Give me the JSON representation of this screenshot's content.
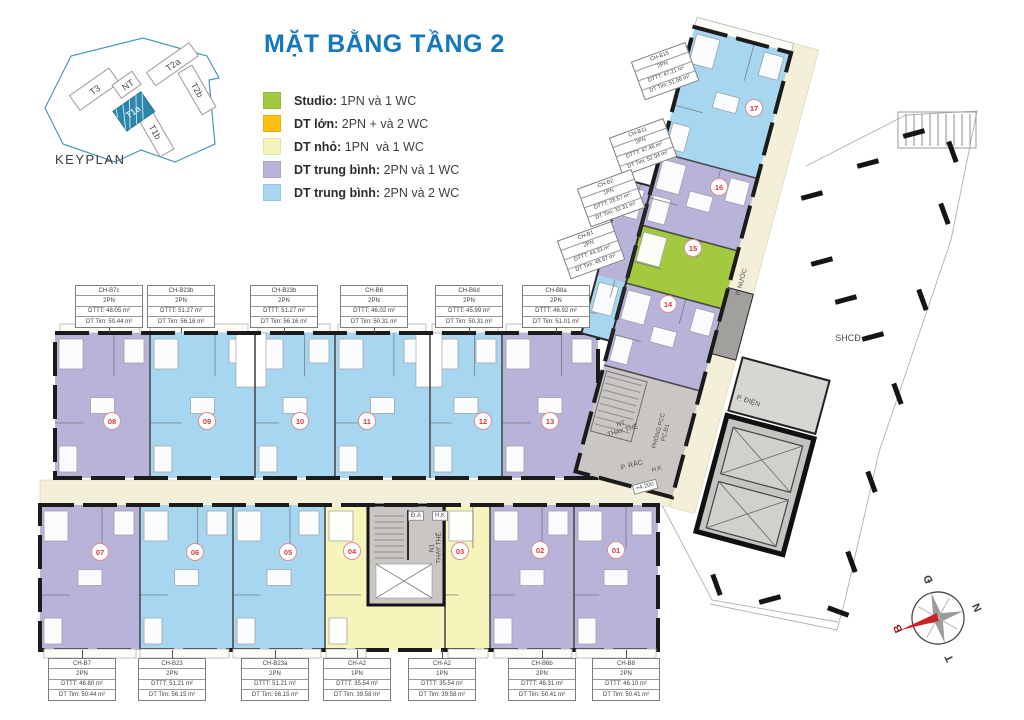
{
  "title": "MẶT BẰNG TẦNG 2",
  "title_color": "#1378be",
  "keyplan": {
    "caption": "KEYPLAN",
    "highlight": "T1a",
    "buildings": [
      {
        "label": "T3"
      },
      {
        "label": "NT"
      },
      {
        "label": "T2a"
      },
      {
        "label": "T2b"
      },
      {
        "label": "T1a"
      },
      {
        "label": "T1b"
      }
    ]
  },
  "legend": {
    "items": [
      {
        "color": "#a3c93f",
        "name": "Studio:",
        "desc": " 1PN và 1 WC"
      },
      {
        "color": "#fdc010",
        "name": "DT lớn:",
        "desc": " 2PN + và 2 WC"
      },
      {
        "color": "#f6f3bb",
        "name": "DT nhỏ:",
        "desc": " 1PN  và 1 WC"
      },
      {
        "color": "#b7b3d9",
        "name": "DT trung bình:",
        "desc": " 2PN và 1 WC"
      },
      {
        "color": "#a7d7f0",
        "name": "DT trung bình:",
        "desc": " 2PN và 2 WC"
      }
    ]
  },
  "plan": {
    "unit_labels": [
      {
        "name": "CH-B7c",
        "type": "2PN",
        "dttt": "DTTT:  48.05 m²",
        "dttim": "DT Tim: 50.44 m²",
        "x": 109,
        "y": 285,
        "rot": 0,
        "leader": "down"
      },
      {
        "name": "CH-B23b",
        "type": "2PN",
        "dttt": "DTTT:  51.27 m²",
        "dttim": "DT Tim: 56.16 m²",
        "x": 181,
        "y": 285,
        "rot": 0,
        "leader": "down"
      },
      {
        "name": "CH-B23b",
        "type": "2PN",
        "dttt": "DTTT:  51.27 m²",
        "dttim": "DT Tim: 56.16 m²",
        "x": 284,
        "y": 285,
        "rot": 0,
        "leader": "down"
      },
      {
        "name": "CH-B6",
        "type": "2PN",
        "dttt": "DTTT:  46.02 m²",
        "dttim": "DT Tim: 50.31 m²",
        "x": 374,
        "y": 285,
        "rot": 0,
        "leader": "down"
      },
      {
        "name": "CH-B6d",
        "type": "2PN",
        "dttt": "DTTT:  45.99 m²",
        "dttim": "DT Tim: 50.31 m²",
        "x": 469,
        "y": 285,
        "rot": 0,
        "leader": "down"
      },
      {
        "name": "CH-B8a",
        "type": "2PN",
        "dttt": "DTTT:  46.92 m²",
        "dttim": "DT Tim: 51.01 m²",
        "x": 556,
        "y": 285,
        "rot": 0,
        "leader": "down"
      },
      {
        "name": "CH-B7",
        "type": "2PN",
        "dttt": "DTTT:  46.80 m²",
        "dttim": "DT Tim: 50.44 m²",
        "x": 82,
        "y": 658,
        "rot": 0,
        "leader": "up"
      },
      {
        "name": "CH-B23",
        "type": "2PN",
        "dttt": "DTTT:  51.21 m²",
        "dttim": "DT Tim: 56.15 m²",
        "x": 172,
        "y": 658,
        "rot": 0,
        "leader": "up"
      },
      {
        "name": "CH-B23a",
        "type": "2PN",
        "dttt": "DTTT:  51.21 m²",
        "dttim": "DT Tim: 56.15 m²",
        "x": 275,
        "y": 658,
        "rot": 0,
        "leader": "up"
      },
      {
        "name": "CH-A2",
        "type": "1PN",
        "dttt": "DTTT:  35.54 m²",
        "dttim": "DT Tim: 39.58 m²",
        "x": 357,
        "y": 658,
        "rot": 0,
        "leader": "up"
      },
      {
        "name": "CH-A2",
        "type": "1PN",
        "dttt": "DTTT:  35.54 m²",
        "dttim": "DT Tim: 39.58 m²",
        "x": 442,
        "y": 658,
        "rot": 0,
        "leader": "up"
      },
      {
        "name": "CH-B6b",
        "type": "2PN",
        "dttt": "DTTT:  46.31 m²",
        "dttim": "DT Tim: 50.41 m²",
        "x": 542,
        "y": 658,
        "rot": 0,
        "leader": "up"
      },
      {
        "name": "CH-B8",
        "type": "2PN",
        "dttt": "DTTT:  46.10 m²",
        "dttim": "DT Tim: 50.41 m²",
        "x": 626,
        "y": 658,
        "rot": 0,
        "leader": "up"
      },
      {
        "name": "CH-B15",
        "type": "2PN",
        "dttt": "DTTT:  47.21 m²",
        "dttim": "DT Tim: 51.66 m²",
        "x": 665,
        "y": 71,
        "rot": -20,
        "leader": "none"
      },
      {
        "name": "CH-B11",
        "type": "2PN",
        "dttt": "DTTT:  47.46 m²",
        "dttim": "DT Tim: 52.04 m²",
        "x": 643,
        "y": 147,
        "rot": -20,
        "leader": "none"
      },
      {
        "name": "CH-B2",
        "type": "1PN",
        "dttt": "DTTT:  28.57 m²",
        "dttim": "DT Tim: 32.31 m²",
        "x": 611,
        "y": 198,
        "rot": -20,
        "leader": "none"
      },
      {
        "name": "CH-B1",
        "type": "2PN",
        "dttt": "DTTT:  44.33 m²",
        "dttim": "DT Tim: 48.67 m²",
        "x": 591,
        "y": 250,
        "rot": -20,
        "leader": "none"
      }
    ],
    "unit_numbers": [
      {
        "n": "08",
        "x": 112,
        "y": 421
      },
      {
        "n": "09",
        "x": 207,
        "y": 421
      },
      {
        "n": "10",
        "x": 300,
        "y": 421
      },
      {
        "n": "11",
        "x": 367,
        "y": 421
      },
      {
        "n": "12",
        "x": 483,
        "y": 421
      },
      {
        "n": "13",
        "x": 550,
        "y": 421
      },
      {
        "n": "07",
        "x": 100,
        "y": 552
      },
      {
        "n": "06",
        "x": 195,
        "y": 552
      },
      {
        "n": "05",
        "x": 288,
        "y": 552
      },
      {
        "n": "04",
        "x": 352,
        "y": 551
      },
      {
        "n": "03",
        "x": 460,
        "y": 551
      },
      {
        "n": "02",
        "x": 540,
        "y": 550
      },
      {
        "n": "01",
        "x": 616,
        "y": 550
      },
      {
        "n": "14",
        "x": 668,
        "y": 304
      },
      {
        "n": "15",
        "x": 693,
        "y": 248
      },
      {
        "n": "16",
        "x": 719,
        "y": 187
      },
      {
        "n": "17",
        "x": 754,
        "y": 108
      }
    ],
    "annotations": [
      {
        "text": "NT\nTHAY THẾ",
        "x": 622,
        "y": 428,
        "rot": -15,
        "fs": 6.5,
        "boxed": false
      },
      {
        "text": "PHÒNG PCC\nPC.Đ1",
        "x": 663,
        "y": 432,
        "rot": -75,
        "fs": 6,
        "boxed": false
      },
      {
        "text": "P. RÁC",
        "x": 632,
        "y": 466,
        "rot": -15,
        "fs": 7,
        "boxed": false
      },
      {
        "text": "H.K",
        "x": 657,
        "y": 470,
        "rot": -15,
        "fs": 6,
        "boxed": false
      },
      {
        "text": "+4.200",
        "x": 645,
        "y": 487,
        "rot": -15,
        "fs": 6,
        "boxed": true
      },
      {
        "text": "P. NƯỚC",
        "x": 742,
        "y": 282,
        "rot": -75,
        "fs": 6.5,
        "boxed": false
      },
      {
        "text": "P. ĐIỆN",
        "x": 748,
        "y": 402,
        "rot": 18,
        "fs": 7,
        "boxed": false
      },
      {
        "text": "SHCĐ",
        "x": 848,
        "y": 338,
        "rot": 0,
        "fs": 9,
        "boxed": false
      },
      {
        "text": "N1\nTHAY THẾ",
        "x": 436,
        "y": 548,
        "rot": -90,
        "fs": 6.5,
        "boxed": false
      },
      {
        "text": "Đ.A",
        "x": 416,
        "y": 516,
        "rot": 0,
        "fs": 6,
        "boxed": true
      },
      {
        "text": "H.K",
        "x": 440,
        "y": 516,
        "rot": 0,
        "fs": 6,
        "boxed": true
      }
    ]
  },
  "compass": {
    "top": "Đ",
    "right": "N",
    "bottom": "T",
    "left": "B"
  },
  "colors": {
    "studio": "#a3c93f",
    "large": "#fdc010",
    "small": "#f6f3bb",
    "medium_1wc": "#b7b3d9",
    "medium_2wc": "#a7d7f0",
    "corridor": "#f3efd8",
    "core": "#c9c6c3",
    "number": "#cf3b3b",
    "title": "#1378be"
  }
}
